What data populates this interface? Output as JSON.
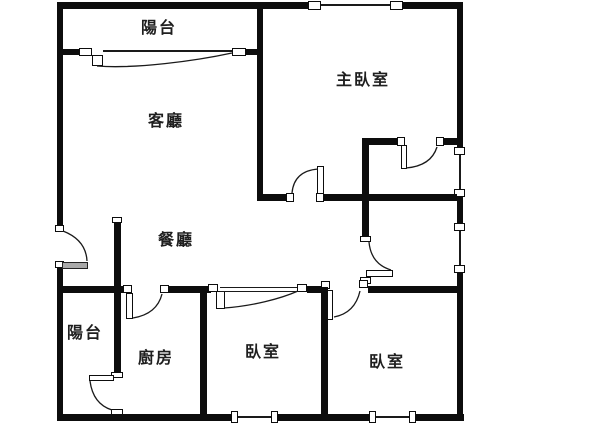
{
  "floorplan": {
    "title": "apartment-floor-plan",
    "background_color": "#ffffff",
    "wall_color": "#0d0d0d",
    "label_color": "#1f1f1f",
    "rooms": [
      {
        "id": "balcony-top",
        "label": "陽台"
      },
      {
        "id": "master-bedroom",
        "label": "主臥室"
      },
      {
        "id": "living-room",
        "label": "客廳"
      },
      {
        "id": "dining-room",
        "label": "餐廳"
      },
      {
        "id": "balcony-bottom",
        "label": "陽台"
      },
      {
        "id": "kitchen",
        "label": "廚房"
      },
      {
        "id": "bedroom-center",
        "label": "臥室"
      },
      {
        "id": "bedroom-right",
        "label": "臥室"
      }
    ]
  }
}
